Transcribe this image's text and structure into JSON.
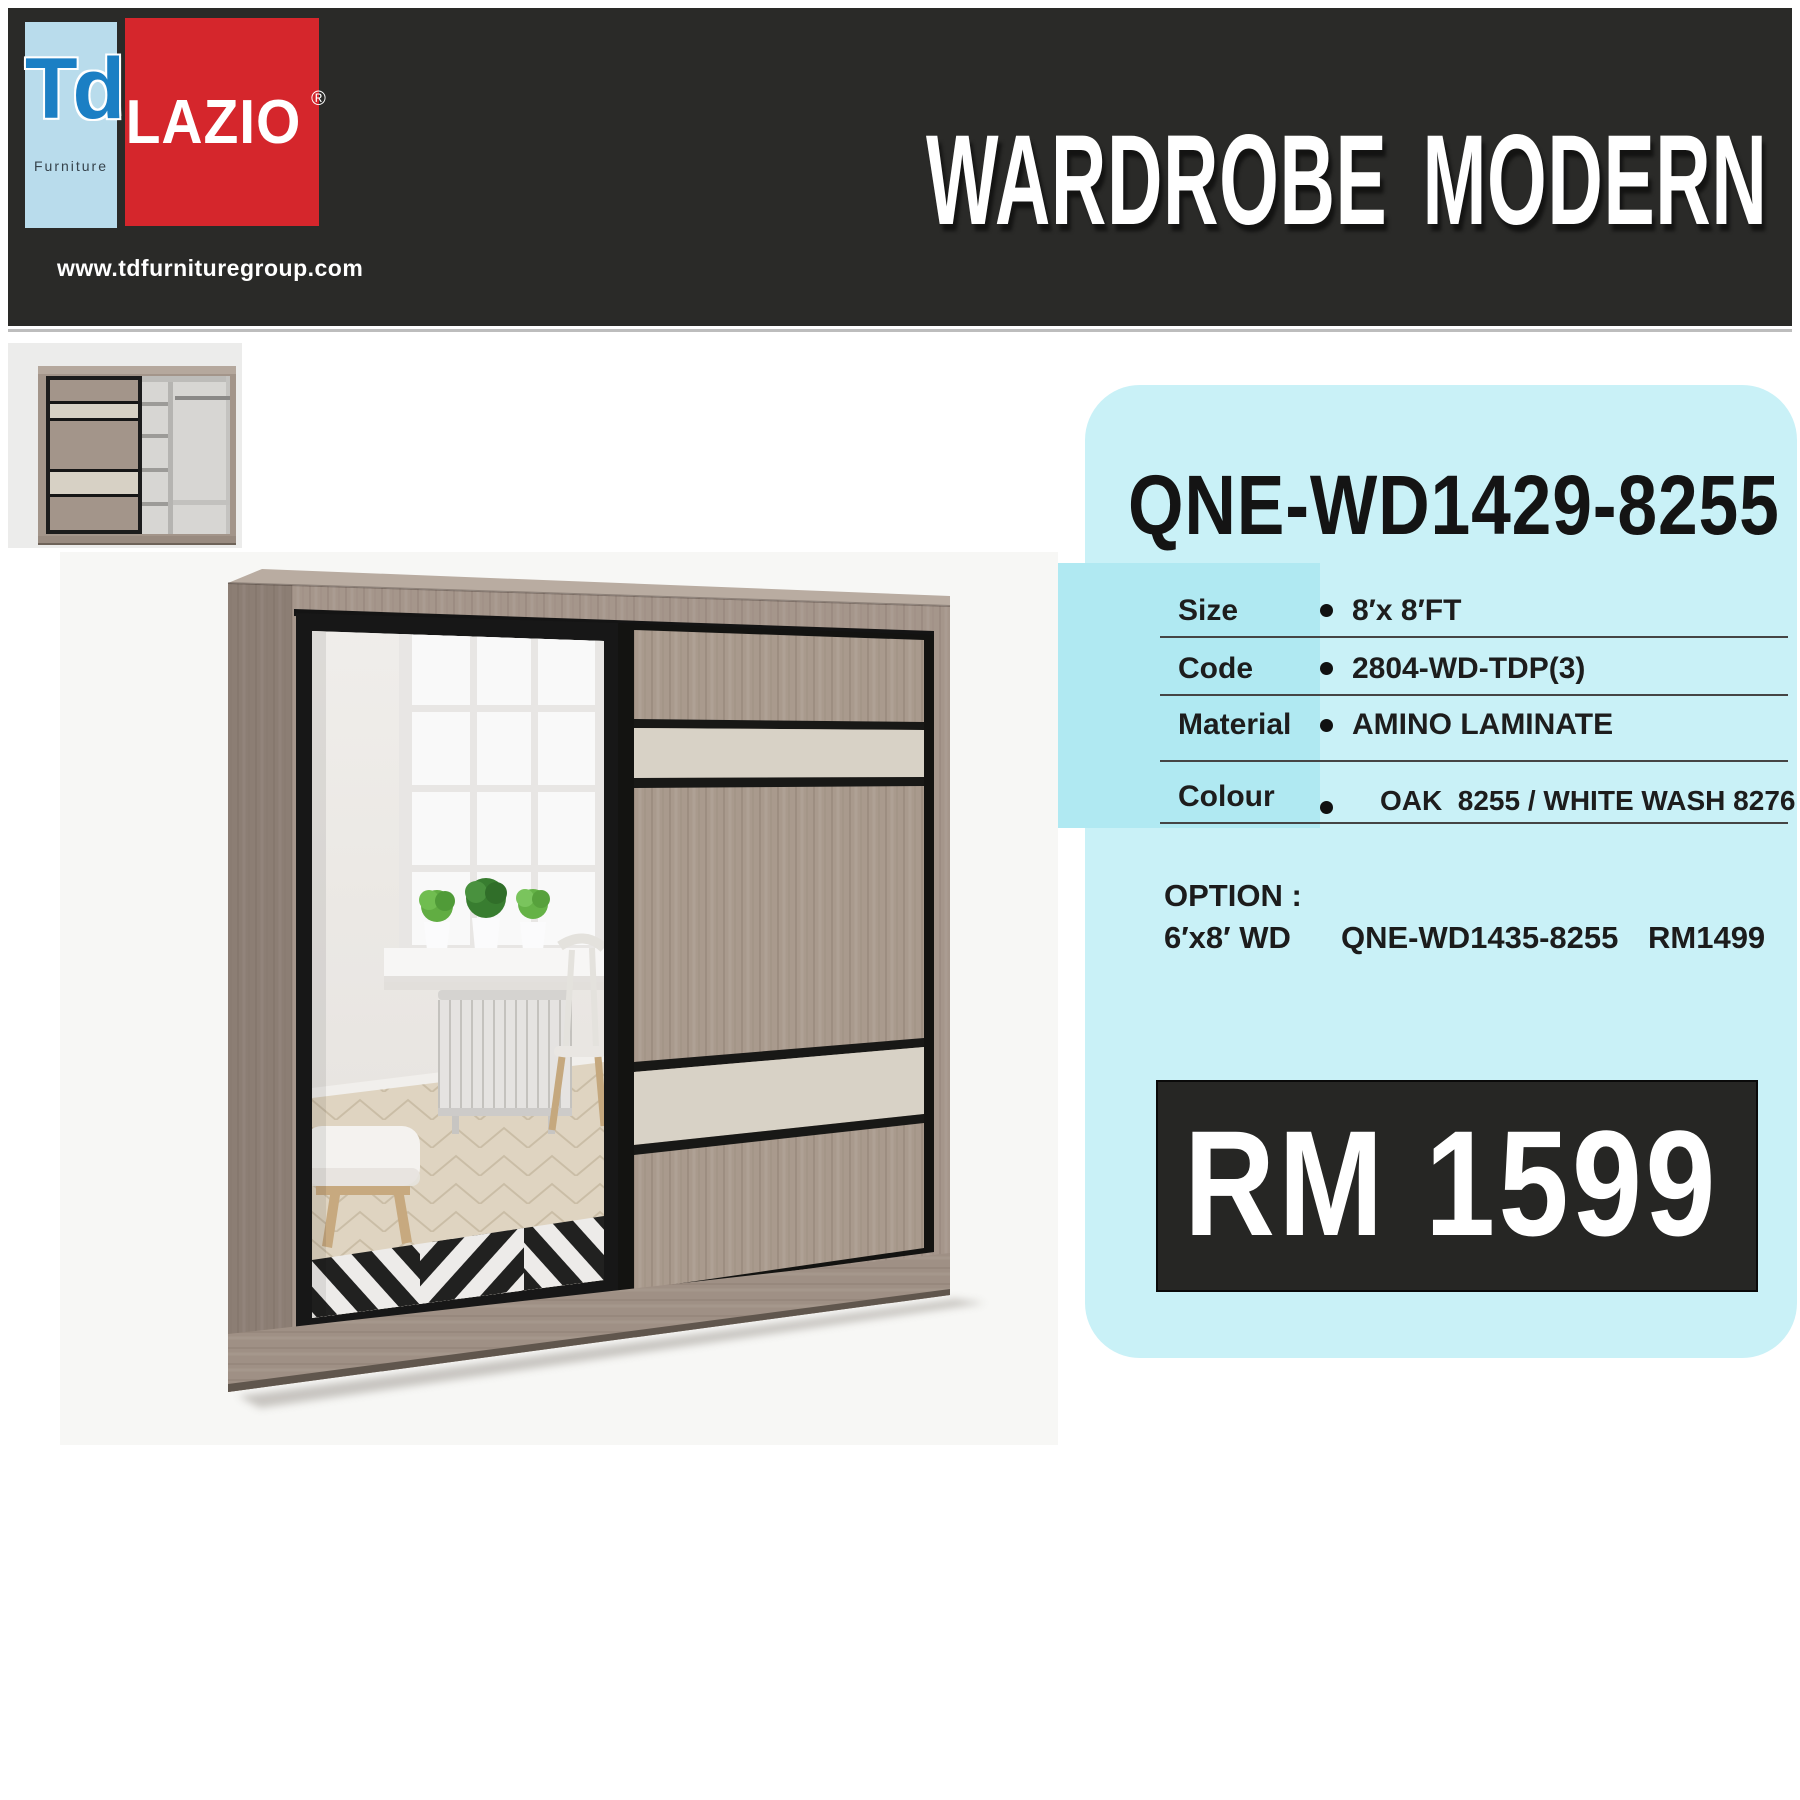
{
  "header": {
    "logo_td": {
      "text": "Td",
      "sub": "Furniture"
    },
    "logo_lazio": {
      "text": "LAZIO",
      "reg": "®"
    },
    "website": "www.tdfurnituregroup.com",
    "title": "WARDROBE MODERN"
  },
  "product": {
    "model": "QNE-WD1429-8255",
    "bullet": "•",
    "specs": [
      {
        "label": "Size",
        "value": "8′x 8′FT"
      },
      {
        "label": "Code",
        "value": "2804-WD-TDP(3)"
      },
      {
        "label": "Material",
        "value": "AMINO LAMINATE"
      },
      {
        "label": "Colour",
        "value": "OAK  8255 / WHITE WASH 8276"
      }
    ],
    "option_heading": "OPTION :",
    "option": {
      "size": "6′x8′ WD",
      "model": "QNE-WD1435-8255",
      "price": "RM1499"
    },
    "price": "RM 1599"
  },
  "colors": {
    "header_dark": "#2a2a28",
    "brand_red": "#d5262c",
    "td_blue": "#1b7fc4",
    "td_bg": "#b9dcec",
    "panel_cyan": "#c9f1f7",
    "band_cyan": "#b0e9f2",
    "price_bg": "#262624",
    "wood": "#a5968b",
    "cream": "#d8d2c6"
  }
}
